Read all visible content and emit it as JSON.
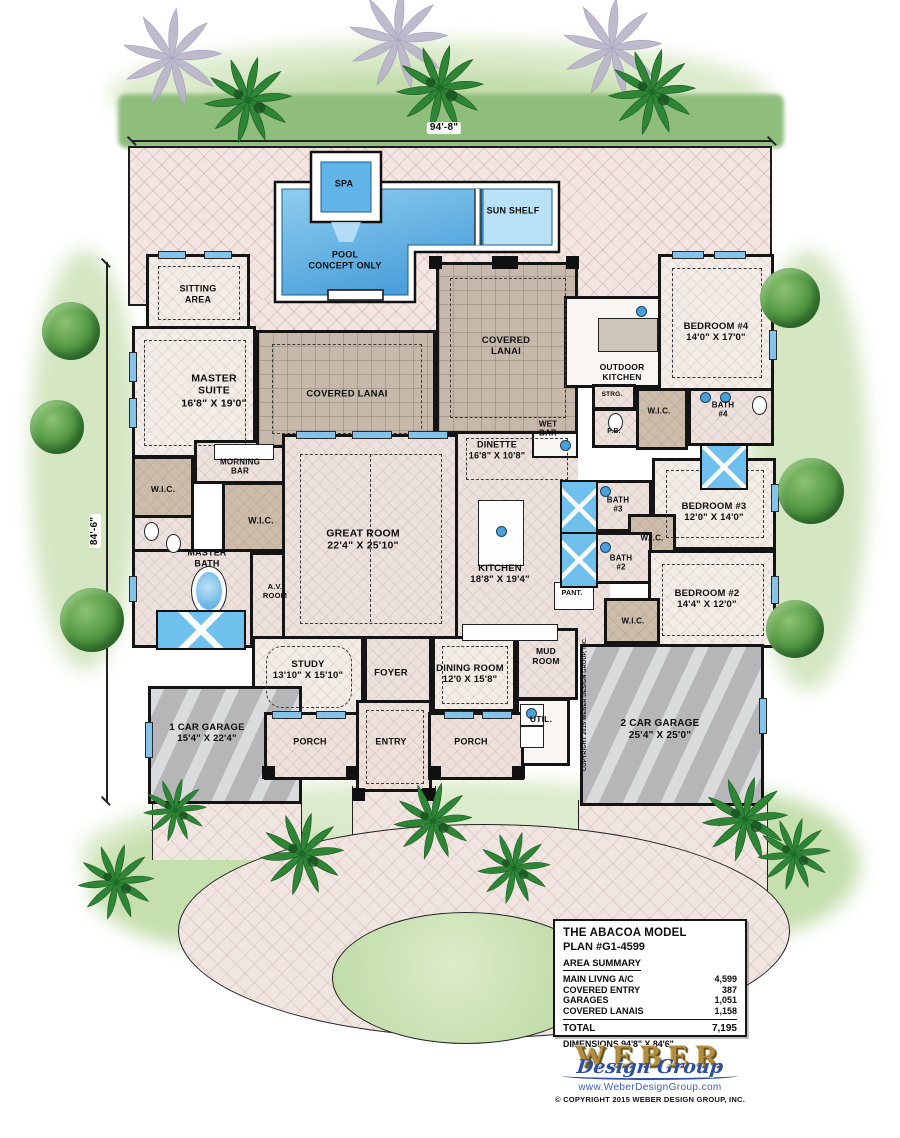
{
  "plan": {
    "top_dimension": "94'-8\"",
    "left_dimension": "84'-6\"",
    "labels": [
      {
        "name": "label-spa",
        "text": "SPA",
        "x": 344,
        "y": 184,
        "size": 9
      },
      {
        "name": "label-sun-shelf",
        "text": "SUN SHELF",
        "x": 513,
        "y": 211,
        "size": 9
      },
      {
        "name": "label-pool-note",
        "text": "POOL\nCONCEPT ONLY",
        "x": 345,
        "y": 260,
        "size": 9
      },
      {
        "name": "label-sitting-area",
        "text": "SITTING\nAREA",
        "x": 198,
        "y": 294,
        "size": 9
      },
      {
        "name": "label-master-suite",
        "text": "MASTER\nSUITE\n16'8\" X 19'0\"",
        "x": 214,
        "y": 391,
        "size": 10.5
      },
      {
        "name": "label-covered-lanai-left",
        "text": "COVERED LANAI",
        "x": 347,
        "y": 394,
        "size": 9.5
      },
      {
        "name": "label-covered-lanai-center",
        "text": "COVERED\nLANAI",
        "x": 506,
        "y": 346,
        "size": 9.5
      },
      {
        "name": "label-outdoor-kitchen",
        "text": "OUTDOOR\nKITCHEN",
        "x": 622,
        "y": 372,
        "size": 8.5
      },
      {
        "name": "label-bedroom-4",
        "text": "BEDROOM #4\n14'0\" X 17'0\"",
        "x": 716,
        "y": 332,
        "size": 9.5
      },
      {
        "name": "label-strg",
        "text": "STRG.",
        "x": 612,
        "y": 395,
        "size": 6.5
      },
      {
        "name": "label-pb",
        "text": "P.B.",
        "x": 614,
        "y": 432,
        "size": 7
      },
      {
        "name": "label-wic-bed4",
        "text": "W.I.C.",
        "x": 659,
        "y": 411,
        "size": 8
      },
      {
        "name": "label-bath-4",
        "text": "BATH\n#4",
        "x": 723,
        "y": 410,
        "size": 8
      },
      {
        "name": "label-wet-bar",
        "text": "WET\nBAR",
        "x": 548,
        "y": 429,
        "size": 8
      },
      {
        "name": "label-dinette",
        "text": "DINETTE\n16'8\" X 10'8\"",
        "x": 497,
        "y": 450,
        "size": 9
      },
      {
        "name": "label-morning-bar",
        "text": "MORNING\nBAR",
        "x": 240,
        "y": 467,
        "size": 8
      },
      {
        "name": "label-wic-master-1",
        "text": "W.I.C.",
        "x": 163,
        "y": 489,
        "size": 8.5
      },
      {
        "name": "label-wic-master-2",
        "text": "W.I.C.",
        "x": 261,
        "y": 521,
        "size": 9
      },
      {
        "name": "label-great-room",
        "text": "GREAT ROOM\n22'4\" X 25'10\"",
        "x": 363,
        "y": 540,
        "size": 10.5
      },
      {
        "name": "label-bath-3",
        "text": "BATH\n#3",
        "x": 618,
        "y": 505,
        "size": 8
      },
      {
        "name": "label-bedroom-3",
        "text": "BEDROOM #3\n12'0\" X 14'0\"",
        "x": 714,
        "y": 512,
        "size": 9.5
      },
      {
        "name": "label-wic-bed3",
        "text": "W.I.C.",
        "x": 652,
        "y": 538,
        "size": 8
      },
      {
        "name": "label-master-bath",
        "text": "MASTER\nBATH",
        "x": 207,
        "y": 558,
        "size": 9
      },
      {
        "name": "label-kitchen",
        "text": "KITCHEN\n18'8\" X 19'4\"",
        "x": 500,
        "y": 574,
        "size": 9.5
      },
      {
        "name": "label-bath-2",
        "text": "BATH\n#2",
        "x": 621,
        "y": 563,
        "size": 8
      },
      {
        "name": "label-av-room",
        "text": "A.V.\nROOM",
        "x": 275,
        "y": 592,
        "size": 7.5
      },
      {
        "name": "label-bedroom-2",
        "text": "BEDROOM #2\n14'4\" X 12'0\"",
        "x": 707,
        "y": 599,
        "size": 9.5
      },
      {
        "name": "label-pant",
        "text": "PANT.",
        "x": 572,
        "y": 594,
        "size": 7
      },
      {
        "name": "label-wic-bed2",
        "text": "W.I.C.",
        "x": 633,
        "y": 621,
        "size": 8
      },
      {
        "name": "label-study",
        "text": "STUDY\n13'10\" X 15'10\"",
        "x": 308,
        "y": 670,
        "size": 9.5
      },
      {
        "name": "label-foyer",
        "text": "FOYER",
        "x": 391,
        "y": 673,
        "size": 9.5
      },
      {
        "name": "label-dining-room",
        "text": "DINING ROOM\n12'0 X 15'8\"",
        "x": 470,
        "y": 674,
        "size": 9.5
      },
      {
        "name": "label-mud-room",
        "text": "MUD\nROOM",
        "x": 546,
        "y": 656,
        "size": 8.5
      },
      {
        "name": "label-util",
        "text": "UTIL.",
        "x": 541,
        "y": 719,
        "size": 8.5
      },
      {
        "name": "label-1-car-garage",
        "text": "1 CAR GARAGE\n15'4\" X 22'4\"",
        "x": 207,
        "y": 733,
        "size": 9.5
      },
      {
        "name": "label-porch-left",
        "text": "PORCH",
        "x": 310,
        "y": 742,
        "size": 9
      },
      {
        "name": "label-entry",
        "text": "ENTRY",
        "x": 391,
        "y": 742,
        "size": 9
      },
      {
        "name": "label-porch-right",
        "text": "PORCH",
        "x": 471,
        "y": 742,
        "size": 9
      },
      {
        "name": "label-2-car-garage",
        "text": "2 CAR GARAGE\n25'4\" X 25'0\"",
        "x": 660,
        "y": 730,
        "size": 10
      },
      {
        "name": "label-dim-top",
        "text": "94'-8\"",
        "x": 444,
        "y": 128,
        "size": 10,
        "bg": true
      },
      {
        "name": "label-dim-left",
        "text": "84'-6\"",
        "x": 95,
        "y": 531,
        "size": 10,
        "rot": -90,
        "bg": true
      },
      {
        "name": "label-side-copyright",
        "text": "COPYRIGHT 2015 WEBER DESIGN GROUP, INC.",
        "x": 585,
        "y": 704,
        "size": 5.5,
        "rot": -90
      }
    ]
  },
  "title_block": {
    "title": "THE ABACOA MODEL",
    "plan_no": "PLAN #G1-4599",
    "area_summary_heading": "AREA SUMMARY",
    "areas": [
      {
        "label": "MAIN LIVNG A/C",
        "value": "4,599"
      },
      {
        "label": "COVERED ENTRY",
        "value": "387"
      },
      {
        "label": "GARAGES",
        "value": "1,051"
      },
      {
        "label": "COVERED LANAIS",
        "value": "1,158"
      }
    ],
    "total_label": "TOTAL",
    "total_value": "7,195",
    "dimensions_line": "DIMENSIONS 94'8\" X 84'6\""
  },
  "branding": {
    "logo_word": "WEBER",
    "logo_script": "Design Group",
    "website": "www.WeberDesignGroup.com",
    "copyright": "© COPYRIGHT 2015 WEBER DESIGN GROUP, INC.",
    "gold": "#b08d42",
    "blue": "#2b4fa8"
  }
}
